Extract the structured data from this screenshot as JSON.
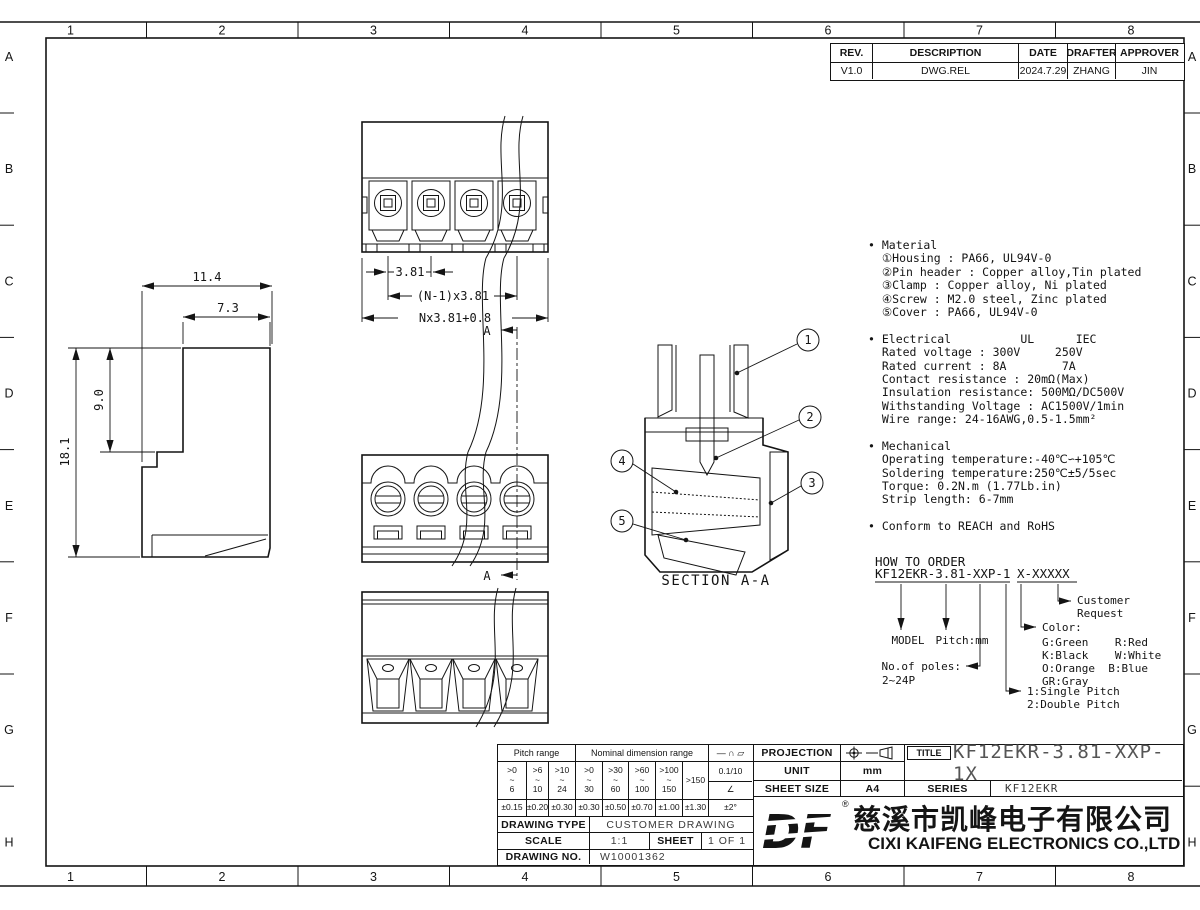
{
  "frame": {
    "columns": [
      "1",
      "2",
      "3",
      "4",
      "5",
      "6",
      "7",
      "8"
    ],
    "rows": [
      "A",
      "B",
      "C",
      "D",
      "E",
      "F",
      "G",
      "H"
    ]
  },
  "revision_table": {
    "headers": [
      "REV.",
      "DESCRIPTION",
      "DATE",
      "DRAFTER",
      "APPROVER"
    ],
    "row": [
      "V1.0",
      "DWG.REL",
      "2024.7.29",
      "ZHANG",
      "JIN"
    ]
  },
  "views": {
    "top_view": {
      "dim_pitch_single": "3.81",
      "dim_pitch_n": "(N-1)x3.81",
      "dim_total": "Nx3.81+0.8"
    },
    "side_view": {
      "dim_width": "11.4",
      "dim_upper_width": "7.3",
      "dim_upper_height": "9.0",
      "dim_height": "18.1"
    },
    "section": {
      "label": "SECTION A-A",
      "marker": "A",
      "balloons": [
        "1",
        "2",
        "3",
        "4",
        "5"
      ]
    }
  },
  "notes": {
    "lines": [
      "• Material",
      "  ①Housing : PA66, UL94V-0",
      "  ②Pin header : Copper alloy,Tin plated",
      "  ③Clamp : Copper alloy, Ni plated",
      "  ④Screw : M2.0 steel, Zinc plated",
      "  ⑤Cover : PA66, UL94V-0",
      "",
      "• Electrical          UL      IEC",
      "  Rated voltage : 300V     250V",
      "  Rated current : 8A        7A",
      "  Contact resistance : 20mΩ(Max)",
      "  Insulation resistance: 500MΩ/DC500V",
      "  Withstanding Voltage : AC1500V/1min",
      "  Wire range: 24-16AWG,0.5-1.5mm²",
      "",
      "• Mechanical",
      "  Operating temperature:-40℃∽+105℃",
      "  Soldering temperature:250℃±5/5sec",
      "  Torque: 0.2N.m (1.77Lb.in)",
      "  Strip length: 6-7mm",
      "",
      "• Conform to REACH and RoHS"
    ]
  },
  "how_to_order": {
    "title": "HOW TO ORDER",
    "code_main": "KF12EKR-3.81-XXP-1",
    "code_suffix": "X-XXXXX",
    "model_label": "MODEL",
    "pitch_label": "Pitch:mm",
    "poles_label_1": "No.of poles:",
    "poles_label_2": "2~24P",
    "pitch_type_1": "1:Single Pitch",
    "pitch_type_2": "2:Double Pitch",
    "color_title": "Color:",
    "colors": [
      "G:Green    R:Red",
      "K:Black    W:White",
      "O:Orange  B:Blue",
      "GR:Gray"
    ],
    "customer_1": "Customer",
    "customer_2": "Request"
  },
  "title_block": {
    "tolerance": {
      "pitch_range_label": "Pitch range",
      "nominal_label": "Nominal dimension range",
      "symbols": "— ∩ ▱",
      "range_top": [
        ">0",
        ">6",
        ">10",
        ">0",
        ">30",
        ">60",
        ">100"
      ],
      "tilde": "~",
      "range_bot": [
        "6",
        "10",
        "24",
        "30",
        "60",
        "100",
        "150"
      ],
      "range_last": ">150",
      "flat_tol": "0.1/10",
      "angle_symbol": "∠",
      "tols": [
        "±0.15",
        "±0.20",
        "±0.30",
        "±0.30",
        "±0.50",
        "±0.70",
        "±1.00",
        "±1.30"
      ],
      "angle_tol": "±2°"
    },
    "drawing_type_label": "DRAWING TYPE",
    "drawing_type": "CUSTOMER DRAWING",
    "scale_label": "SCALE",
    "scale": "1:1",
    "sheet_label": "SHEET",
    "sheet": "1 OF 1",
    "drawing_no_label": "DRAWING NO.",
    "drawing_no": "W10001362",
    "projection_label": "PROJECTION",
    "unit_label": "UNIT",
    "unit": "mm",
    "sheet_size_label": "SHEET SIZE",
    "sheet_size": "A4",
    "title_label": "TITLE",
    "title": "KF12EKR-3.81-XXP-1X",
    "series_label": "SERIES",
    "series": "KF12EKR"
  },
  "company": {
    "logo": "DF",
    "reg": "®",
    "name_cn": "慈溪市凯峰电子有限公司",
    "name_en": "CIXI KAIFENG ELECTRONICS CO.,LTD"
  }
}
